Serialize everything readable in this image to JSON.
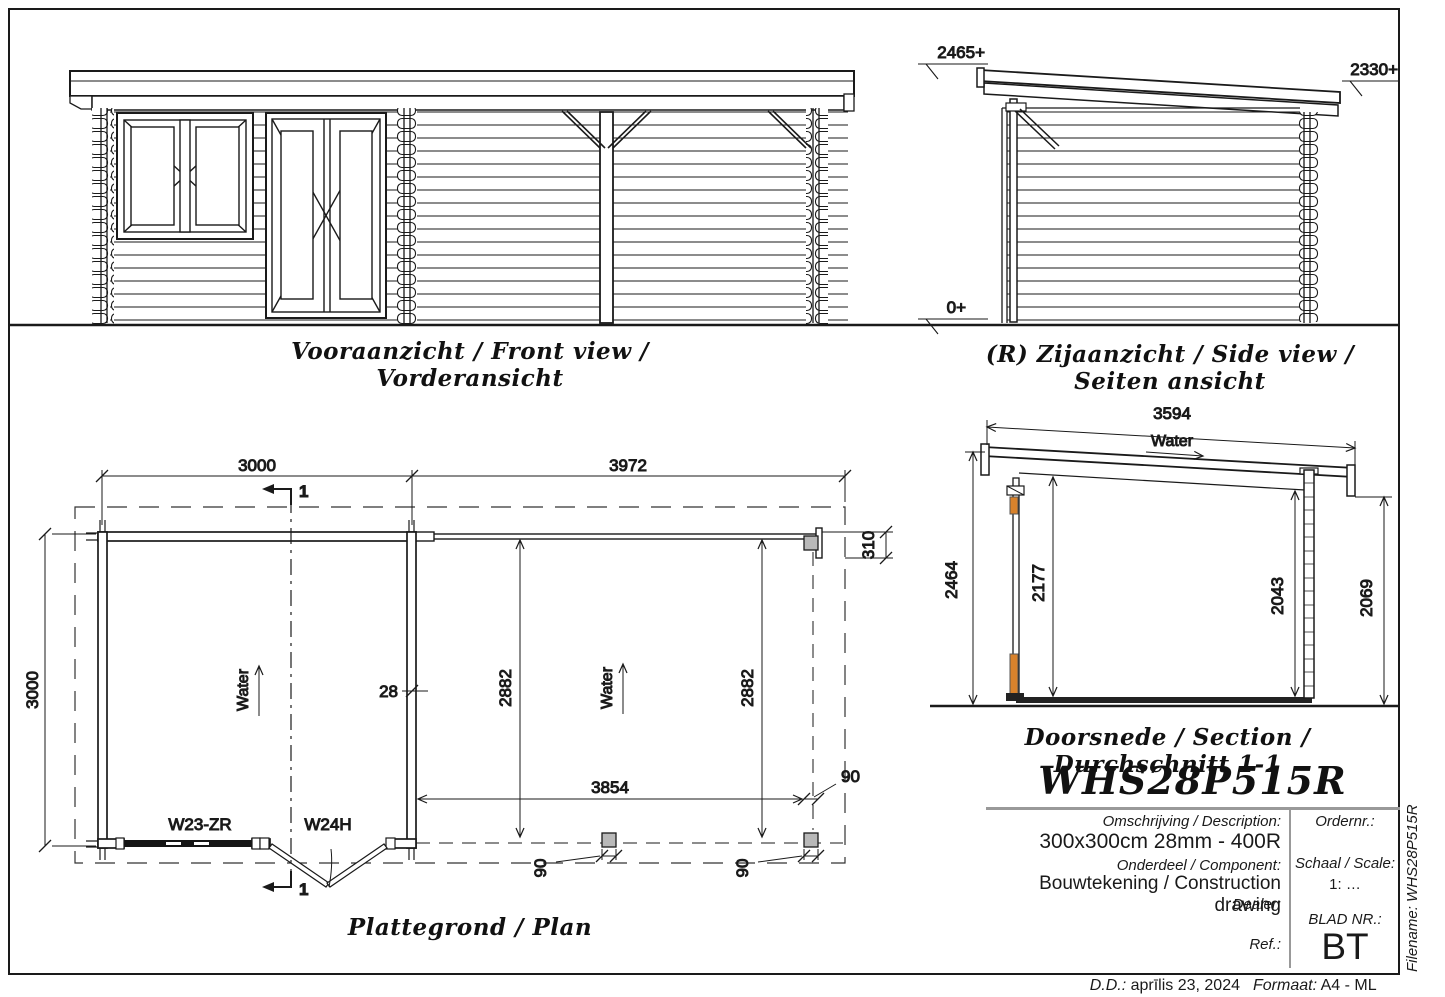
{
  "captions": {
    "front_view": "Vooraanzicht / Front view / Vorderansicht",
    "side_view": "(R) Zijaanzicht / Side view / Seiten ansicht",
    "plan": "Plattegrond / Plan",
    "section": "Doorsnede / Section / Durchschnitt 1-1"
  },
  "model_code": "WHS28P515R",
  "side_view": {
    "level_eave": "2465+",
    "level_rear": "2330+",
    "level_ground": "0+"
  },
  "plan": {
    "dim_cabin_width": "3000",
    "dim_canopy_width": "3972",
    "dim_cabin_depth": "3000",
    "dim_wall_thickness": "28",
    "dim_inner_depth_left": "2882",
    "dim_inner_depth_right": "2882",
    "dim_canopy_clear_width": "3854",
    "dim_roof_overhang": "310",
    "dim_post_top": "90",
    "dim_post_bottom_left": "90",
    "dim_post_bottom_right": "90",
    "water_left": "Water",
    "water_right": "Water",
    "window_code": "W23-ZR",
    "door_code": "W24H",
    "section_marker": "1"
  },
  "section": {
    "dim_roof_length": "3594",
    "water": "Water",
    "dim_height_left": "2464",
    "dim_height_inner_left": "2177",
    "dim_height_inner_right": "2043",
    "dim_height_right": "2069"
  },
  "title_block": {
    "description_label": "Omschrijving / Description:",
    "description_value": "300x300cm 28mm - 400R",
    "component_label": "Onderdeel / Component:",
    "component_value": "Bouwtekening / Construction drawing",
    "dealer_label": "Dealer:",
    "ref_label": "Ref.:",
    "order_label": "Ordernr.:",
    "scale_label": "Schaal / Scale:",
    "scale_value": "1: …",
    "sheet_label": "BLAD NR.:",
    "sheet_value": "BT",
    "date_label": "D.D.:",
    "date_value": "aprīlis 23, 2024",
    "format_label": "Formaat:",
    "format_value": "A4 - ML",
    "filename_label": "Filename:",
    "filename_value": "WHS28P515R"
  },
  "colors": {
    "line": "#1a1a1a",
    "post_fill": "#b9b9b9",
    "wood_accent": "#d9822b",
    "divider_gray": "#999999"
  }
}
